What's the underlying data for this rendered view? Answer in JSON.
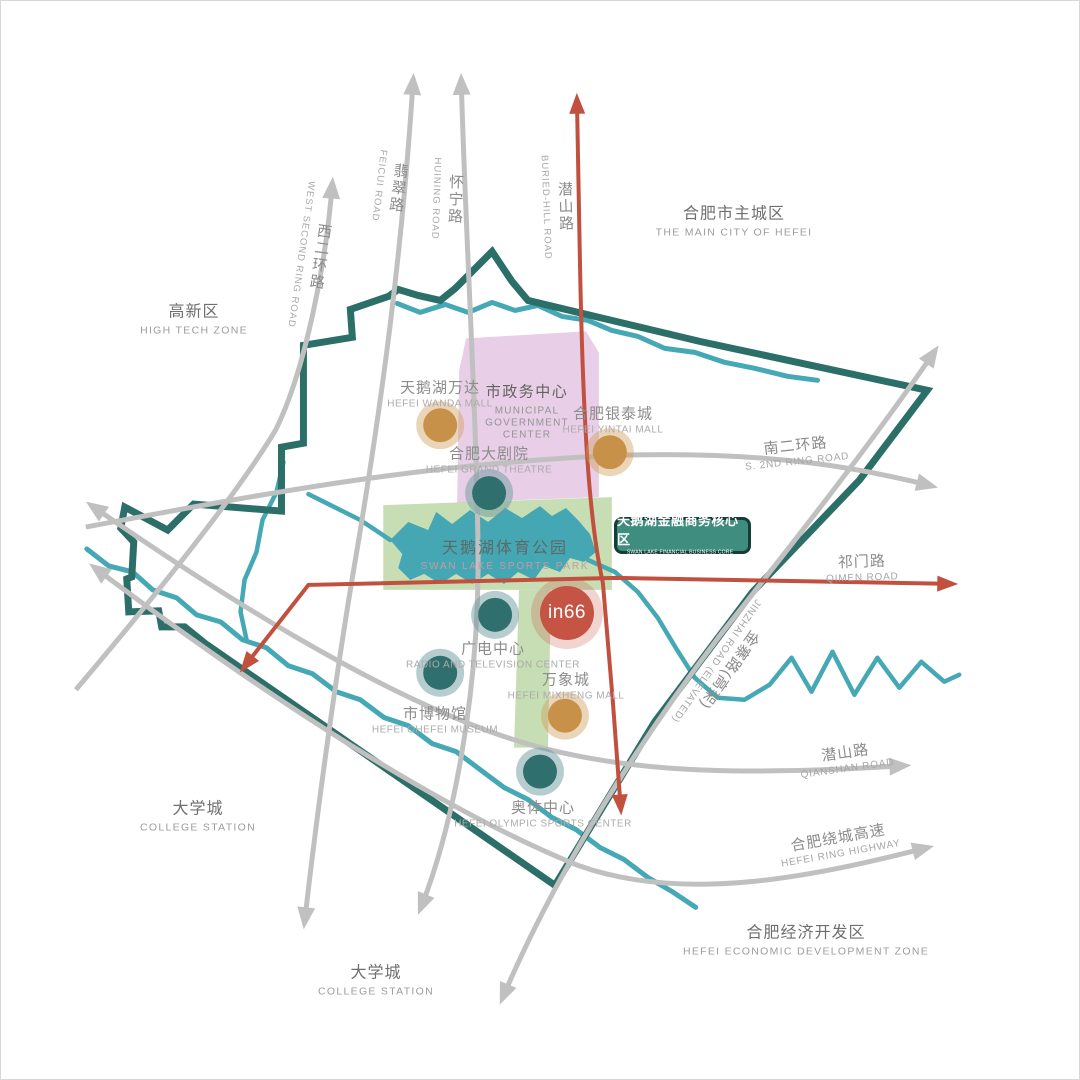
{
  "badge": {
    "cn": "天鹅湖金融商务核心区",
    "en": "SWAN LAKE FINANCIAL BUSINESS CORE AREA"
  },
  "marker": {
    "label": "in66"
  },
  "regions": [
    {
      "id": "high-tech-zone",
      "cn": "高新区",
      "en": "HIGH TECH ZONE"
    },
    {
      "id": "main-city-of-hefei",
      "cn": "合肥市主城区",
      "en": "THE MAIN CITY OF HEFEI"
    },
    {
      "id": "college-station-west",
      "cn": "大学城",
      "en": "COLLEGE STATION"
    },
    {
      "id": "college-station-south",
      "cn": "大学城",
      "en": "COLLEGE STATION"
    },
    {
      "id": "economic-development-zone",
      "cn": "合肥经济开发区",
      "en": "HEFEI ECONOMIC DEVELOPMENT ZONE"
    }
  ],
  "roads": [
    {
      "id": "west-second-ring",
      "cn": "西二环路",
      "en": "WEST SECOND RING ROAD",
      "type": "gray"
    },
    {
      "id": "feicui",
      "cn": "翡翠路",
      "en": "FEICUI ROAD",
      "type": "gray"
    },
    {
      "id": "huining",
      "cn": "怀宁路",
      "en": "HUINING ROAD",
      "type": "gray"
    },
    {
      "id": "buried-hill",
      "cn": "潜山路",
      "en": "BURIED-HILL ROAD",
      "type": "red"
    },
    {
      "id": "south-second-ring",
      "cn": "南二环路",
      "en": "S. 2ND RING ROAD",
      "type": "gray"
    },
    {
      "id": "qimen",
      "cn": "祁门路",
      "en": "QIMEN ROAD",
      "type": "red"
    },
    {
      "id": "jinzhai-elevated",
      "cn": "金寨路(高架)",
      "en": "JINZHAI ROAD (ELEVATED)",
      "type": "gray"
    },
    {
      "id": "qianshan",
      "cn": "潜山路",
      "en": "QIANSHAN ROAD",
      "type": "gray"
    },
    {
      "id": "ring-highway",
      "cn": "合肥绕城高速",
      "en": "HEFEI RING HIGHWAY",
      "type": "gray"
    }
  ],
  "landmarks": [
    {
      "id": "wanda-mall",
      "cn": "天鹅湖万达",
      "en": "HEFEI WANDA MALL",
      "color": "orange"
    },
    {
      "id": "yintai-mall",
      "cn": "合肥银泰城",
      "en": "HEFEI YINTAI MALL",
      "color": "orange"
    },
    {
      "id": "grand-theatre",
      "cn": "合肥大剧院",
      "en": "HEFEI GRAND THEATRE",
      "color": "teal"
    },
    {
      "id": "radio-tv-center",
      "cn": "广电中心",
      "en": "RADIO AND TELEVISION CENTER",
      "color": "teal"
    },
    {
      "id": "hefei-museum",
      "cn": "市博物馆",
      "en": "HEFEI OHEFEI MUSEUM",
      "color": "teal"
    },
    {
      "id": "mixc-mall",
      "cn": "万象城",
      "en": "HEFEI MIXHENG MALL",
      "color": "orange"
    },
    {
      "id": "olympic-sports-center",
      "cn": "奥体中心",
      "en": "HEFEI OLYMPIC SPORTS CENTER",
      "color": "teal"
    }
  ],
  "areas": [
    {
      "id": "municipal-government-center",
      "cn": "市政务中心",
      "en_lines": [
        "MUNICIPAL",
        "GOVERNMENT",
        "CENTER"
      ]
    },
    {
      "id": "swan-lake-sports-park",
      "cn": "天鹅湖体育公园",
      "en": "SWAN LAKE SPORTS PARK"
    }
  ],
  "colors": {
    "boundary_teal": "#2b6f68",
    "water_teal": "#45a8b5",
    "park_green": "#bdd7a7",
    "government_purple": "#e6c9e3",
    "road_gray": "#c0c0c0",
    "road_red": "#c1503e",
    "landmark_orange": "#c8914a",
    "landmark_teal": "#2f6f6e",
    "marker_red": "#c65445",
    "badge_green": "#3f8d7e"
  }
}
